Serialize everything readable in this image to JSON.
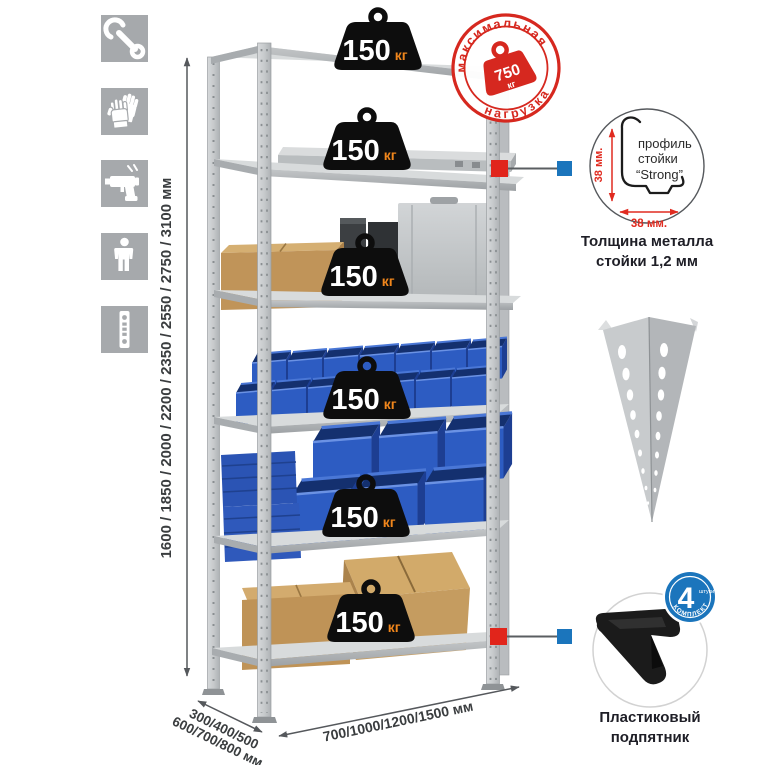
{
  "icons": {
    "items": [
      "wrench-icon",
      "gloves-icon",
      "drill-icon",
      "person-icon",
      "perforated-strip-icon"
    ]
  },
  "dimensions": {
    "height": "1600 / 1850 / 2000 / 2200 / 2350 / 2550 / 2750 / 3100 мм",
    "depth_line1": "300/400/500",
    "depth_line2": "600/700/800 мм",
    "width": "700/1000/1200/1500 мм"
  },
  "shelf_badges": [
    {
      "value": "150",
      "unit": "кг"
    },
    {
      "value": "150",
      "unit": "кг"
    },
    {
      "value": "150",
      "unit": "кг"
    },
    {
      "value": "150",
      "unit": "кг"
    },
    {
      "value": "150",
      "unit": "кг"
    },
    {
      "value": "150",
      "unit": "кг"
    }
  ],
  "stamp": {
    "arc_top": "максимальная",
    "arc_bottom": "нагрузка",
    "value": "750",
    "unit": "кг"
  },
  "profile_detail": {
    "dim_v": "38 мм.",
    "dim_h": "38 мм.",
    "label1": "профиль",
    "label2": "стойки",
    "label3": "“Strong”",
    "caption1": "Толщина металла",
    "caption2": "стойки 1,2 мм"
  },
  "foot_detail": {
    "count": "4",
    "count_note": "штуки",
    "arc": "в комплекте",
    "caption1": "Пластиковый",
    "caption2": "подпятник"
  },
  "colors": {
    "accent_red": "#d6281f",
    "marker_red": "#e1251b",
    "marker_blue": "#1b75bc",
    "badge_black": "#0d0d0d",
    "unit_orange": "#f0861c",
    "bin_blue": "#2d5cc2",
    "metal_gray": "#c7cacc",
    "icon_gray": "#a6a9ac"
  }
}
